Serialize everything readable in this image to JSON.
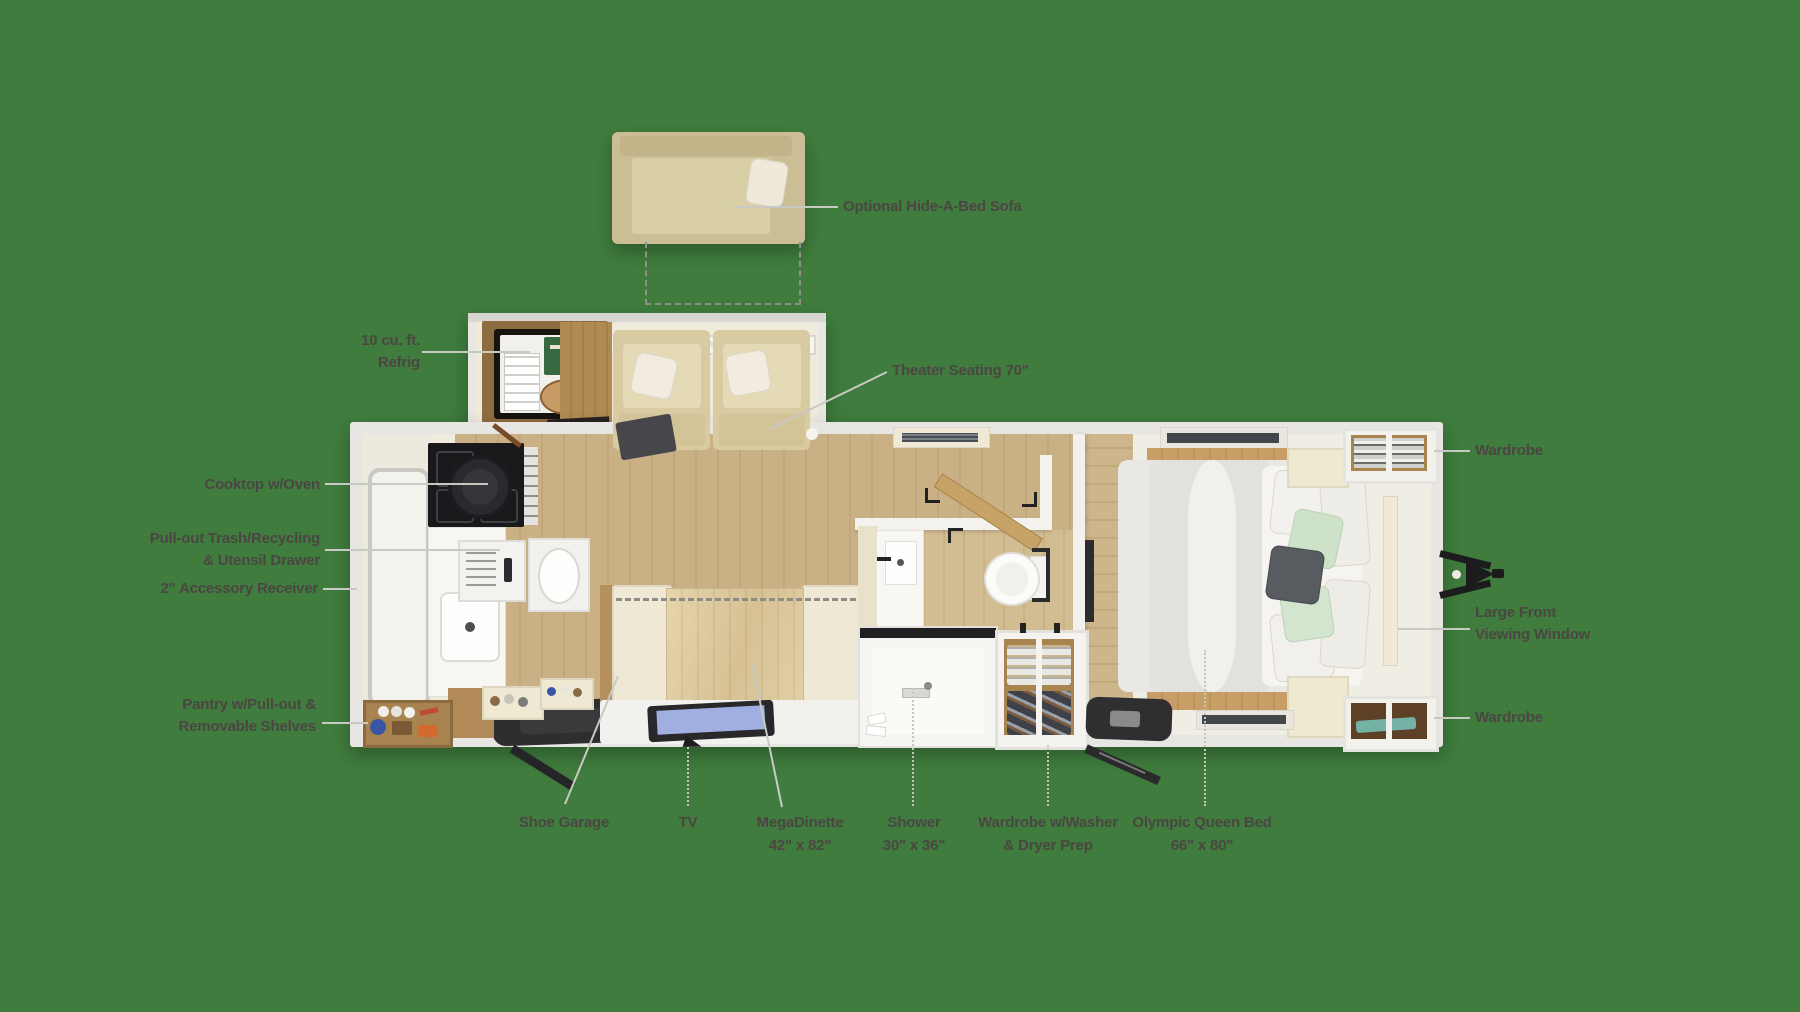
{
  "title": "Travel trailer floor plan",
  "background_color": "#3f7c3d",
  "label_text_color": "#4b4643",
  "leader_line_color": "#c9c9c4",
  "palette": {
    "trailer_shell": "#e7e6e2",
    "interior_wall": "#efebdf",
    "wood_floor": "#c9b185",
    "sofa_tan": "#cbbe95",
    "seat_cream": "#d8cba1",
    "cabinet_wood": "#a8854f",
    "appliance_black": "#19191c",
    "tv_screen": "#a0afe0",
    "mat_dark": "#2e2e30",
    "pillow_mint": "#cde2c9",
    "pillow_gray": "#585c60"
  },
  "labels": {
    "sofa": {
      "text": "Optional Hide-A-Bed Sofa"
    },
    "refrig": {
      "line1": "10 cu. ft.",
      "line2": "Refrig"
    },
    "theater": {
      "text": "Theater Seating 70\""
    },
    "cooktop": {
      "text": "Cooktop w/Oven"
    },
    "trash": {
      "line1": "Pull-out Trash/Recycling",
      "line2": "& Utensil Drawer"
    },
    "receiver": {
      "text": "2\" Accessory Receiver"
    },
    "pantry": {
      "line1": "Pantry w/Pull-out &",
      "line2": "Removable Shelves"
    },
    "shoe": {
      "text": "Shoe Garage"
    },
    "tv": {
      "text": "TV"
    },
    "dinette": {
      "line1": "MegaDinette",
      "line2": "42\" x 82\""
    },
    "shower": {
      "line1": "Shower",
      "line2": "30\" x 36\""
    },
    "washer": {
      "line1": "Wardrobe w/Washer",
      "line2": "& Dryer Prep"
    },
    "bed": {
      "line1": "Olympic Queen Bed",
      "line2": "66\" x 80\""
    },
    "wardrobe_front_top": {
      "text": "Wardrobe"
    },
    "front_window": {
      "line1": "Large Front",
      "line2": "Viewing Window"
    },
    "wardrobe_front_bottom": {
      "text": "Wardrobe"
    }
  }
}
